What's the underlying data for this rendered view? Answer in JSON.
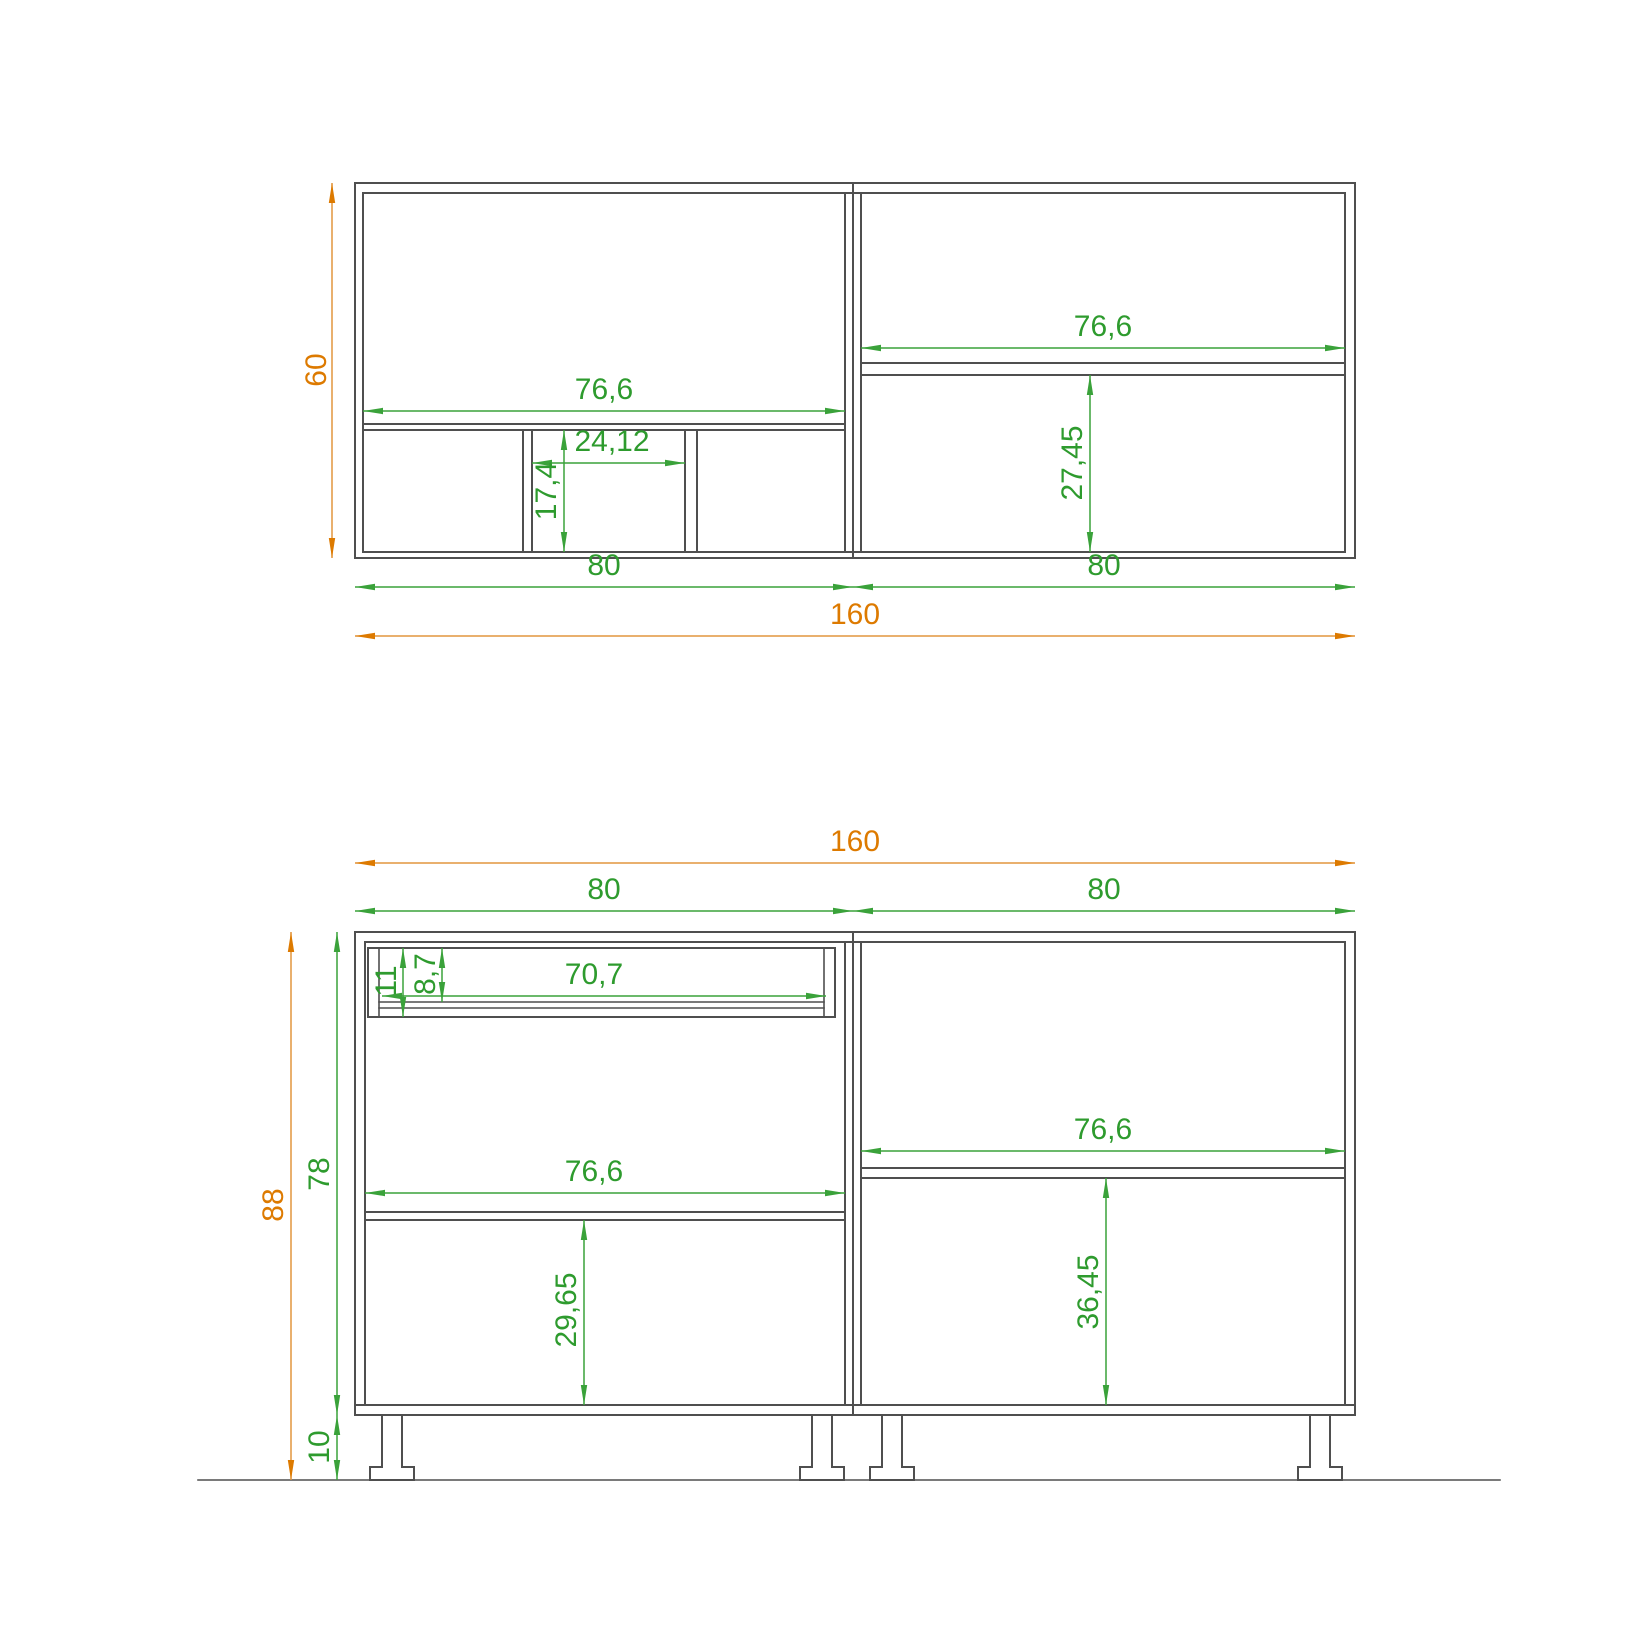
{
  "drawing": {
    "type": "cabinet technical drawing, plan view (top) and front elevation (bottom)",
    "colors": {
      "structure_line": "#4f4f4f",
      "dim_green_text": "#2e9b2e",
      "dim_green_line": "#3aa23a",
      "dim_orange_text": "#dd7a00",
      "dim_orange_line": "#e2953f",
      "background": "#ffffff"
    },
    "top_view": {
      "dims": {
        "depth": "60",
        "left_interior_width": "76,6",
        "niche_width": "24,12",
        "niche_depth": "17,4",
        "right_interior_width": "76,6",
        "right_rear_depth": "27,45",
        "left_module_width": "80",
        "right_module_width": "80",
        "total_width": "160"
      }
    },
    "front_view": {
      "dims": {
        "total_width": "160",
        "left_module_width": "80",
        "right_module_width": "80",
        "total_height": "88",
        "carcass_height": "78",
        "leg_height": "10",
        "drawer_front_height": "11",
        "drawer_opening_height": "8,7",
        "drawer_opening_width": "70,7",
        "left_interior_width": "76,6",
        "left_lower_section_height": "29,65",
        "right_interior_width": "76,6",
        "right_lower_section_height": "36,45"
      }
    }
  }
}
